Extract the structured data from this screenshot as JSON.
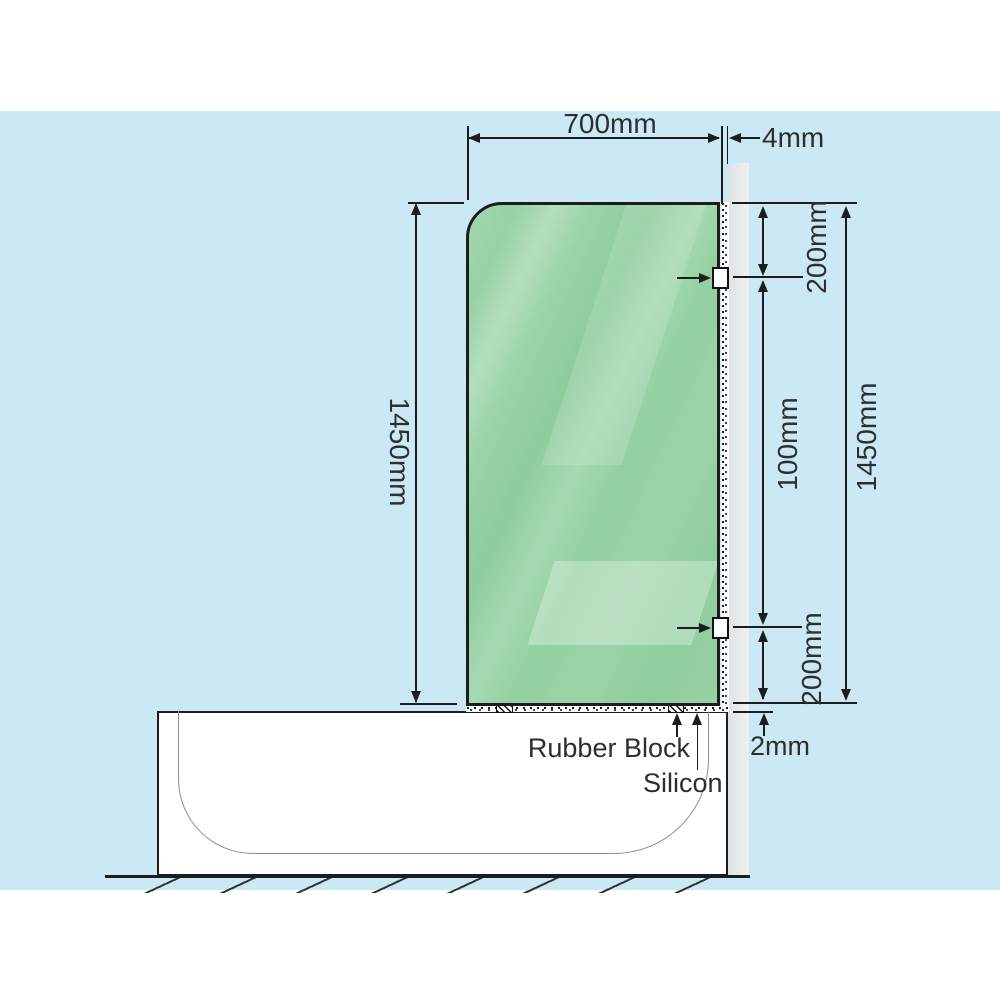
{
  "diagram": {
    "type": "installation-dimension-diagram",
    "subject": "Over-bath shower screen fixed to wall, side elevation",
    "dims": {
      "glass_width_top": "700mm",
      "glass_to_wall_gap": "4mm",
      "glass_height_left": "1450mm",
      "wall_total_height": "1450mm",
      "top_bracket_offset": "200mm",
      "bracket_spacing": "100mm",
      "bottom_bracket_offset": "200mm",
      "glass_to_tub_gap": "2mm"
    },
    "callouts": {
      "rubber_block": "Rubber Block",
      "silicon": "Silicon"
    },
    "colors": {
      "background": "#cbe9f4",
      "line": "#1d1d1d",
      "glass_green": "#9ad3a7",
      "glass_highlight": "#c6e8cc",
      "wall_gray": "#e1e4e4",
      "tub_white": "#ffffff",
      "inner_profile_gray": "#8d8d8d",
      "bracket_white": "#fdfdfd"
    }
  }
}
